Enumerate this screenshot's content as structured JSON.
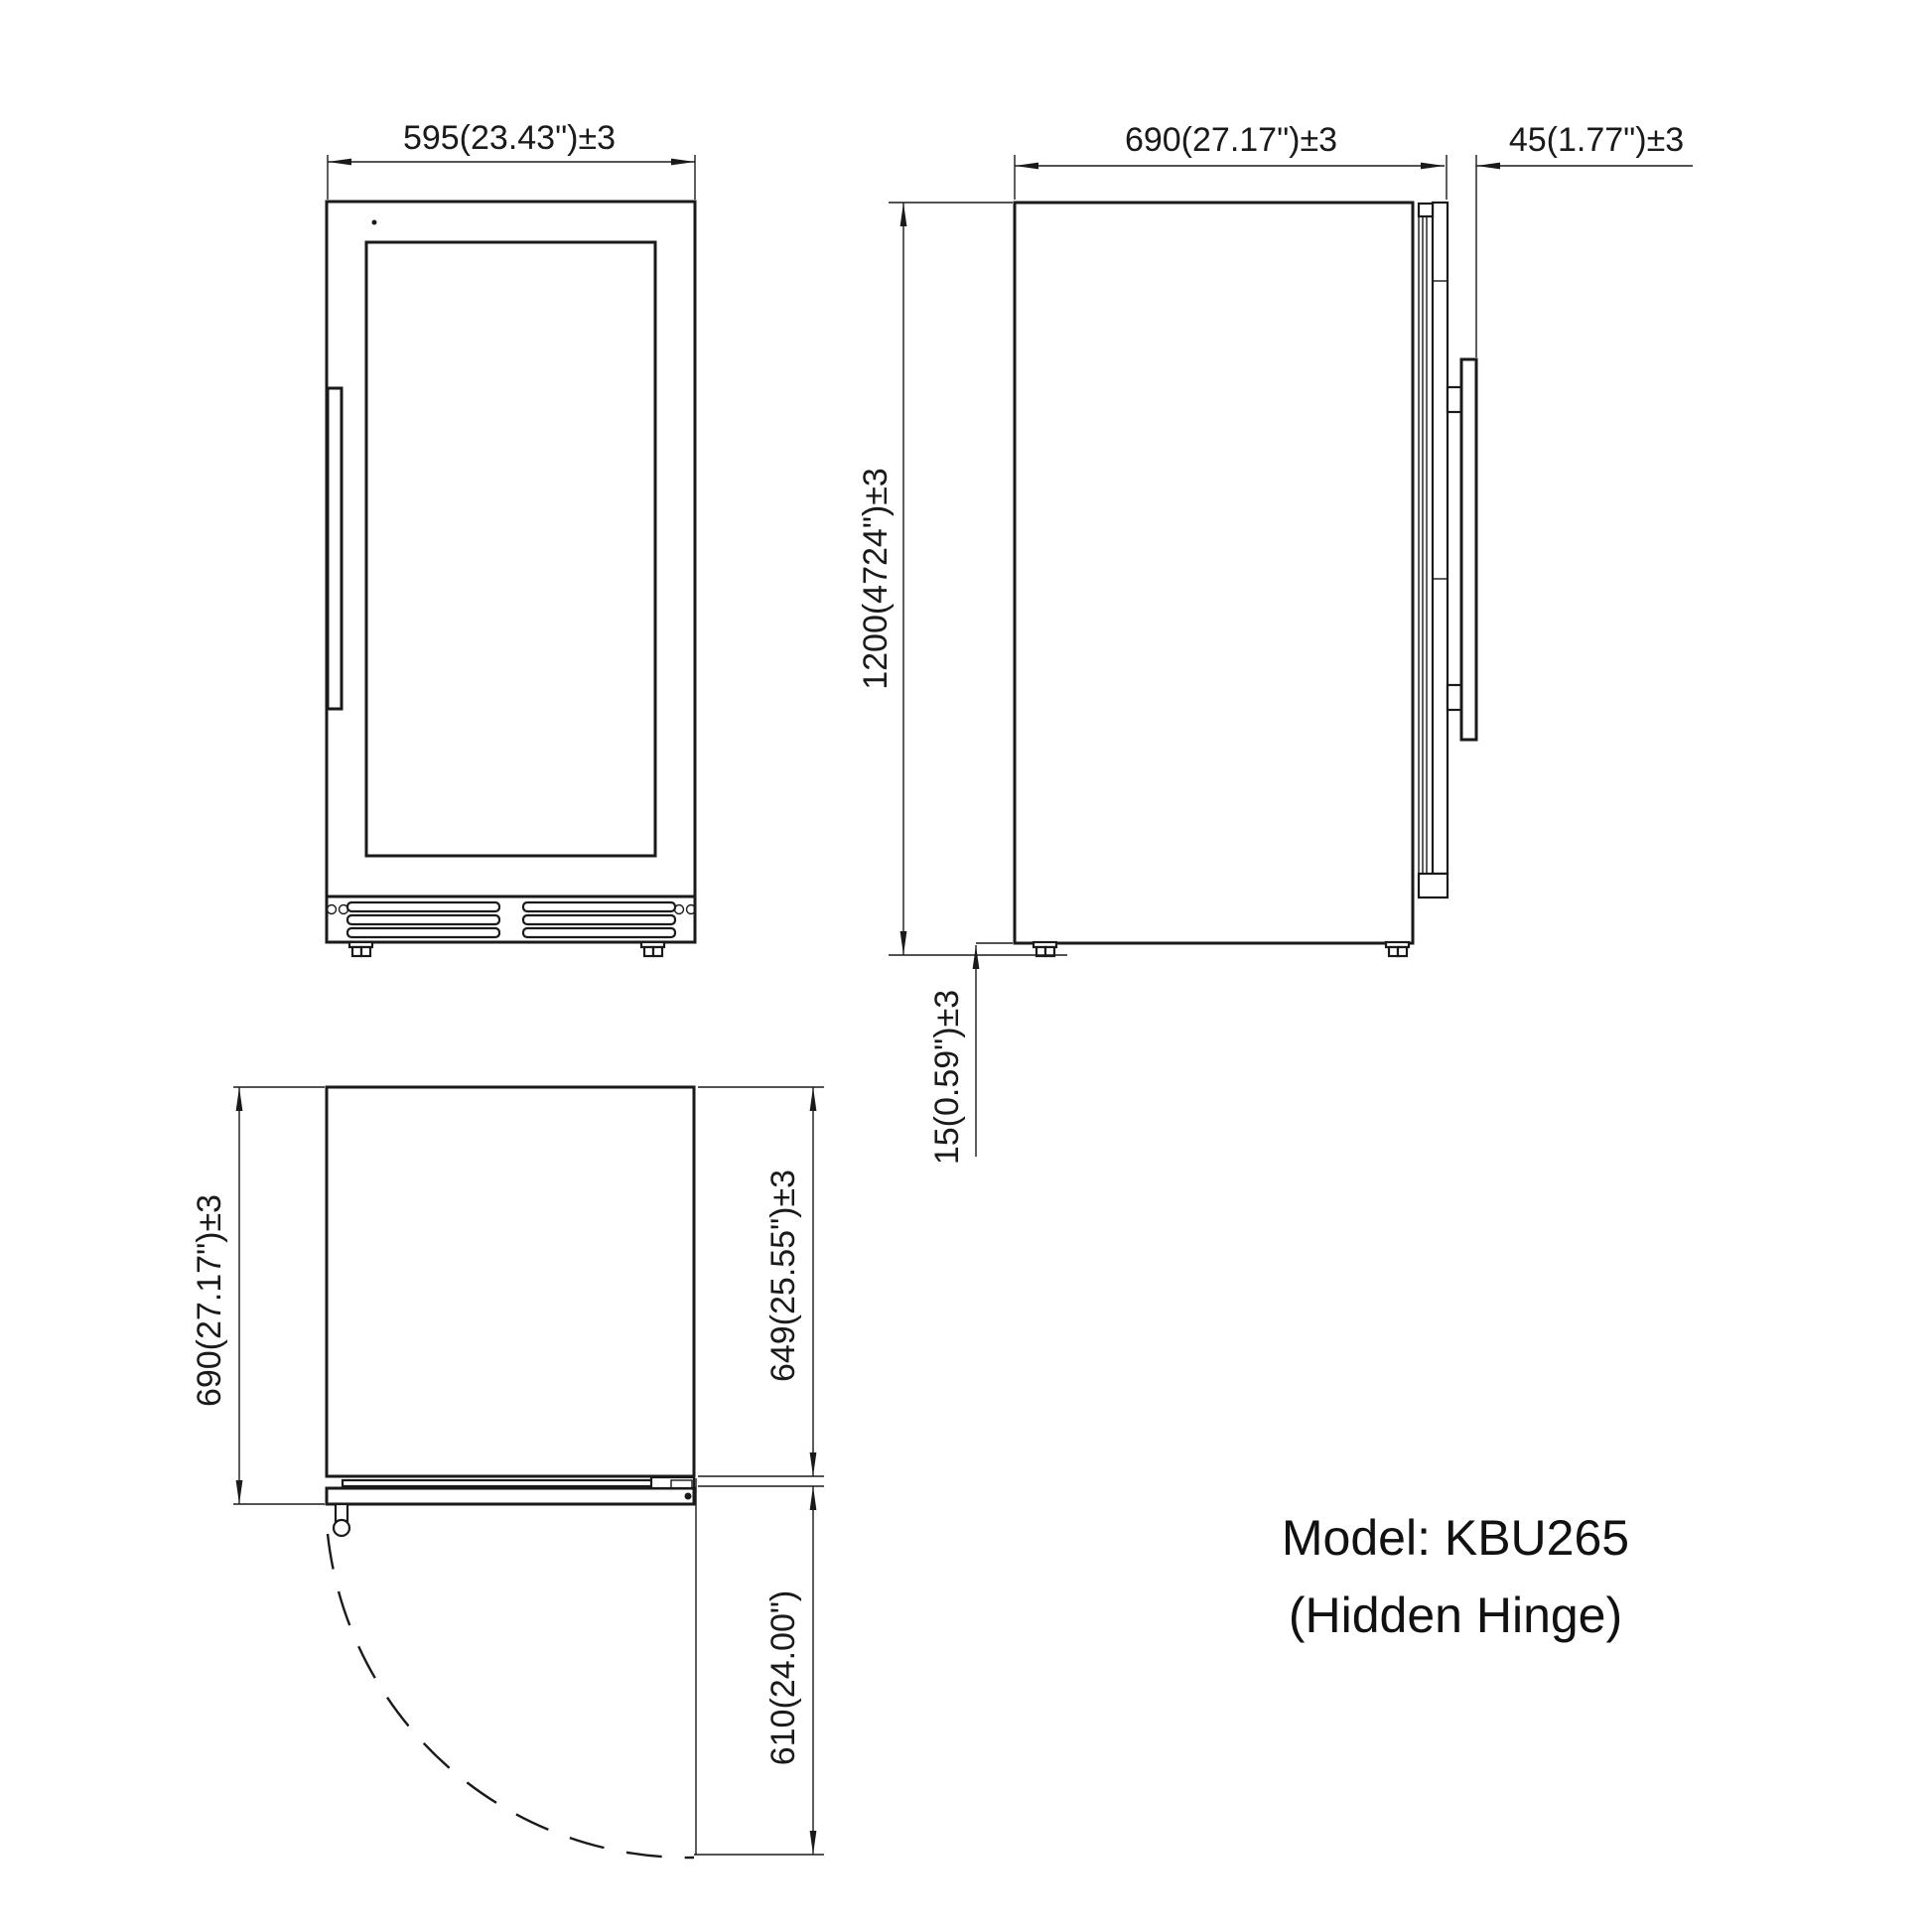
{
  "front_view": {
    "width_label": "595(23.43\")±3"
  },
  "side_view": {
    "depth_label": "690(27.17\")±3",
    "handle_depth_label": "45(1.77\")±3",
    "height_label": "1200(4724\")±3",
    "ground_clearance_label": "15(0.59\")±3"
  },
  "top_view": {
    "total_depth_label": "690(27.17\")±3",
    "cabinet_depth_label": "649(25.55\")±3",
    "door_swing_label": "610(24.00\")"
  },
  "model": {
    "line1": "Model: KBU265",
    "line2": "(Hidden Hinge)"
  },
  "colors": {
    "line": "#1a1a1a",
    "background": "#ffffff"
  }
}
